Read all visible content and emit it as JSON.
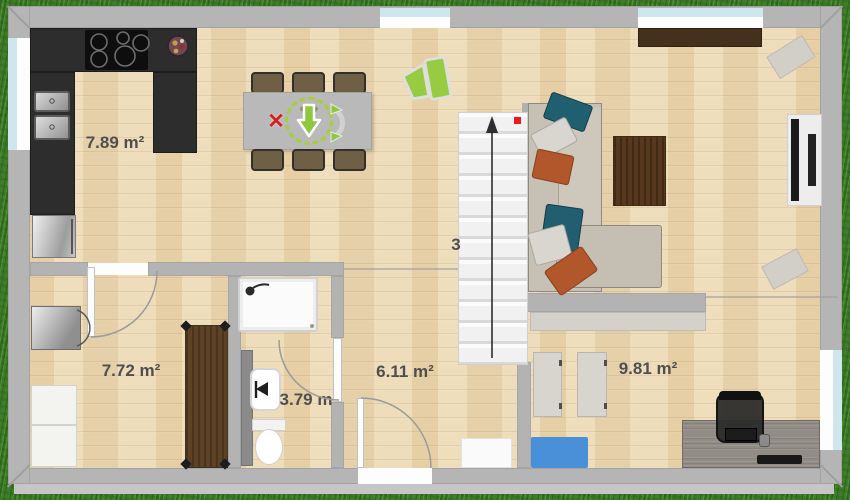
{
  "view": {
    "name": "floor-plan-top-view"
  },
  "rooms": {
    "kitchen": {
      "label": "7.89 m²"
    },
    "bedroom": {
      "label": "7.72 m²"
    },
    "bathroom": {
      "label": "3.79 m"
    },
    "hallway": {
      "label": "6.11 m²"
    },
    "office": {
      "label": "9.81 m²"
    }
  },
  "stairs": {
    "count_label": "3"
  },
  "icons": {
    "delete_icon": "✕",
    "move_arrow_icon": "⬇",
    "rotate_handle_icon": "⟳",
    "camera_marker_icon": "camera-frustum",
    "stairs_arrow_icon": "↑",
    "shower_head_icon": "shower-head"
  },
  "colors": {
    "selection_green": "#a6cf3e",
    "widget_green": "#8fc83e",
    "delete_red": "#d42020",
    "marker_red": "#ea1b1b",
    "mat_blue": "#4a90d9",
    "wall_gray": "#b5b5b5",
    "floor_wood": "#ecd9b4",
    "grass_green": "#3f7e2b",
    "counter_black": "#2d2d2d"
  }
}
